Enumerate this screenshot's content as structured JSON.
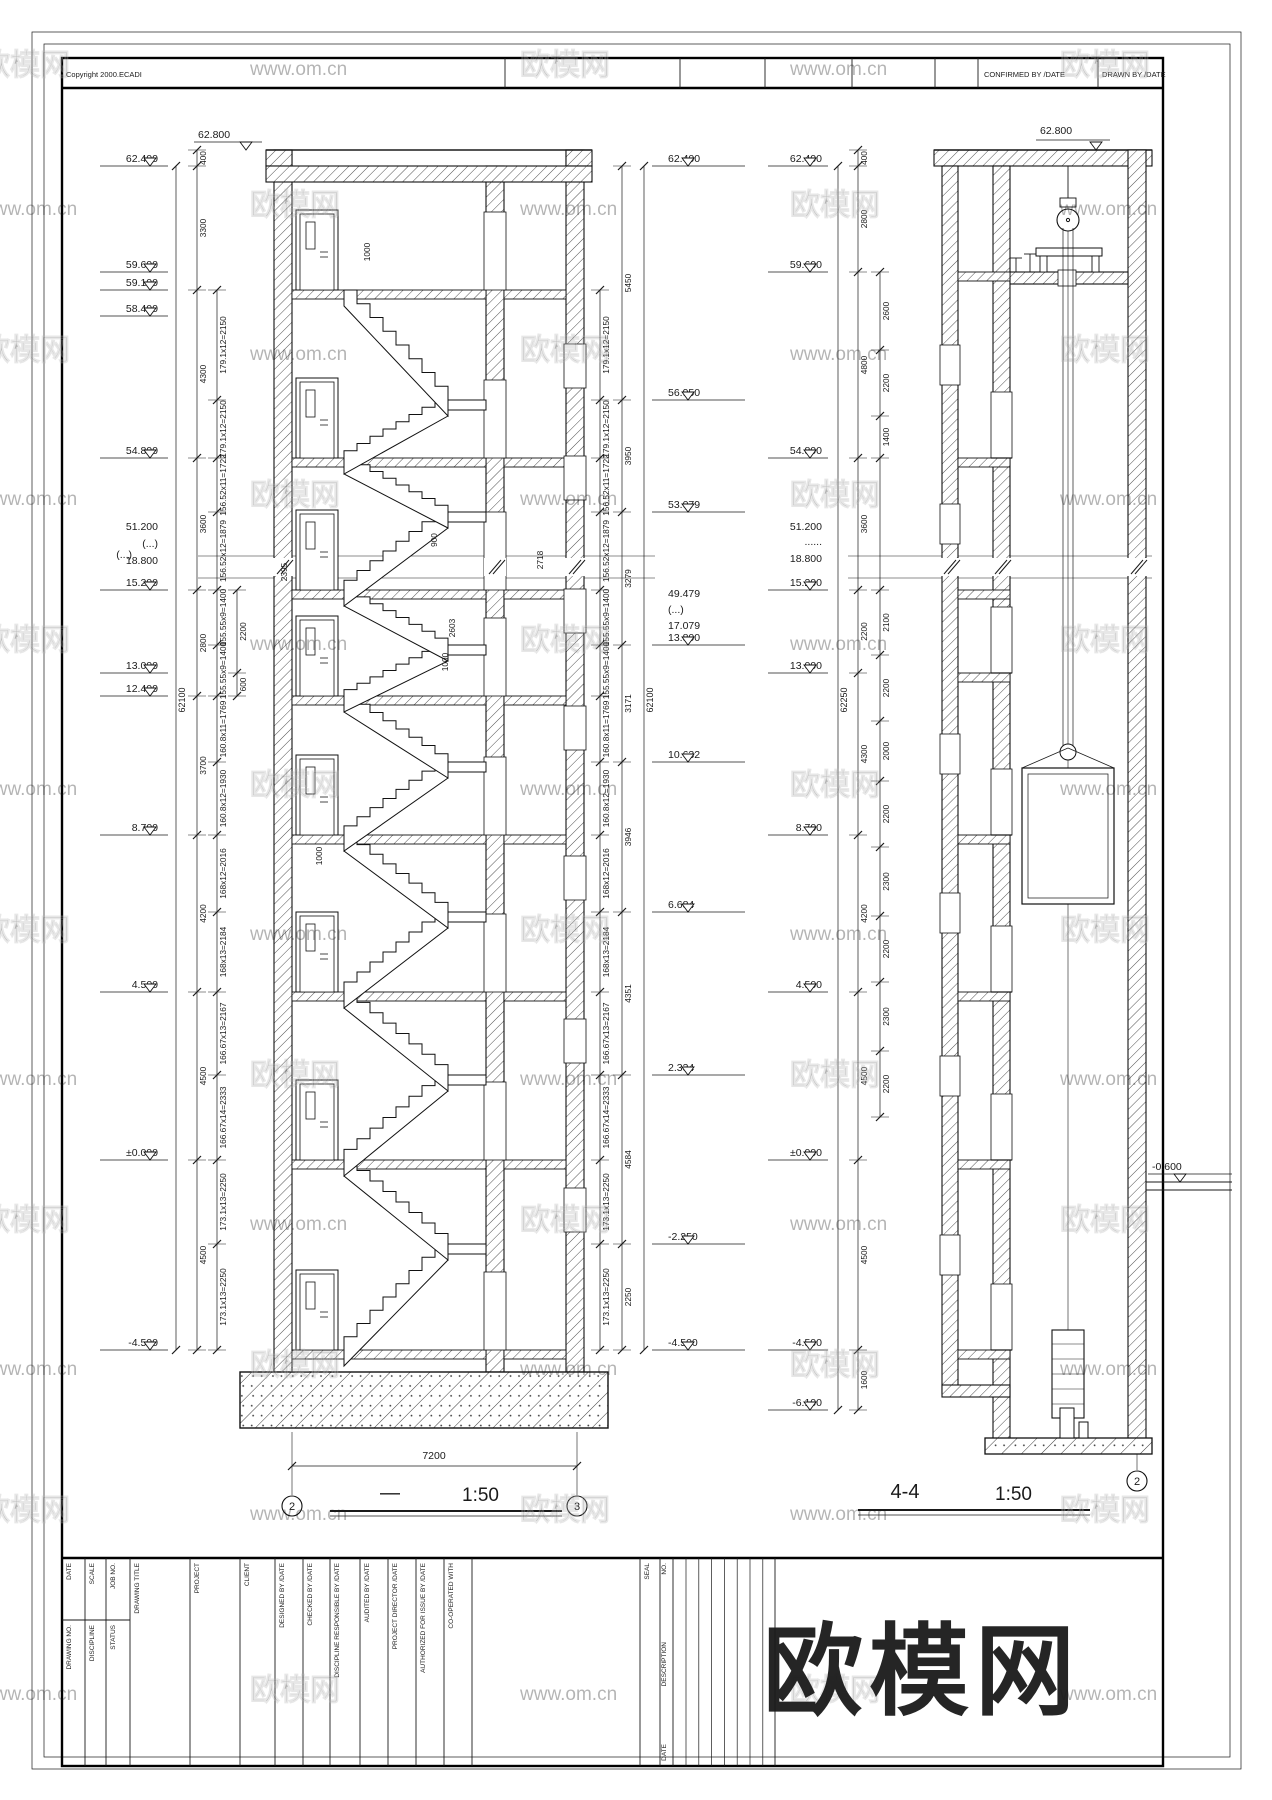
{
  "header": {
    "copyright": "Copyright  2000.ECADI",
    "confirmed": "CONFIRMED BY /DATE",
    "drawn": "DRAWN BY /DATE"
  },
  "watermark": {
    "brand": "欧模网",
    "site": "www.om.cn"
  },
  "stair_section": {
    "title": "—",
    "scale": "1:50",
    "grid_bubbles": [
      "2",
      "3"
    ],
    "width_dim": "7200",
    "overall_dim": "62100",
    "roof_elev": "62.800",
    "break_note": "(...)",
    "elevations_left": [
      {
        "v": "62.400",
        "y": 166
      },
      {
        "v": "59.600",
        "y": 272
      },
      {
        "v": "59.100",
        "y": 290
      },
      {
        "v": "58.400",
        "y": 316
      },
      {
        "v": "54.800",
        "y": 458
      },
      {
        "v": "51.200",
        "y": 534,
        "nf": 1
      },
      {
        "v": "(...)",
        "y": 551,
        "nf": 1
      },
      {
        "v": "18.800",
        "y": 568,
        "nf": 1
      },
      {
        "v": "15.200",
        "y": 590
      },
      {
        "v": "13.000",
        "y": 673
      },
      {
        "v": "12.400",
        "y": 696
      },
      {
        "v": "8.700",
        "y": 835
      },
      {
        "v": "4.500",
        "y": 992
      },
      {
        "v": "±0.000",
        "y": 1160
      },
      {
        "v": "-4.500",
        "y": 1350
      }
    ],
    "elevations_right": [
      {
        "v": "62.400",
        "y": 166
      },
      {
        "v": "56.950",
        "y": 400
      },
      {
        "v": "53.079",
        "y": 512
      },
      {
        "v": "49.479",
        "y": 601,
        "nf": 1
      },
      {
        "v": "(...)",
        "y": 617,
        "nf": 1
      },
      {
        "v": "17.079",
        "y": 633,
        "nf": 1
      },
      {
        "v": "13.800",
        "y": 645
      },
      {
        "v": "10.632",
        "y": 762
      },
      {
        "v": "6.684",
        "y": 912
      },
      {
        "v": "2.334",
        "y": 1075
      },
      {
        "v": "-2.250",
        "y": 1244
      },
      {
        "v": "-4.500",
        "y": 1350
      }
    ],
    "floor_chain": [
      {
        "a": 150,
        "b": 166,
        "v": "400"
      },
      {
        "a": 166,
        "b": 290,
        "v": "3300"
      },
      {
        "a": 290,
        "b": 458,
        "v": "4300"
      },
      {
        "a": 458,
        "b": 590,
        "v": "3600"
      },
      {
        "a": 590,
        "b": 696,
        "v": "2800"
      },
      {
        "a": 696,
        "b": 835,
        "v": "3700"
      },
      {
        "a": 835,
        "b": 992,
        "v": "4200"
      },
      {
        "a": 992,
        "b": 1160,
        "v": "4500"
      },
      {
        "a": 1160,
        "b": 1350,
        "v": "4500"
      }
    ],
    "flight_chain": [
      {
        "a": 290,
        "b": 400,
        "v": "179.1x12=2150"
      },
      {
        "a": 400,
        "b": 458,
        "v": "179.1x12=2150"
      },
      {
        "a": 458,
        "b": 512,
        "v": "156.52x11=1722"
      },
      {
        "a": 512,
        "b": 590,
        "v": "156.52x12=1879"
      },
      {
        "a": 590,
        "b": 645,
        "v": "155.55x9=1400"
      },
      {
        "a": 645,
        "b": 696,
        "v": "155.55x9=1400"
      },
      {
        "a": 696,
        "b": 762,
        "v": "160.8x11=1769"
      },
      {
        "a": 762,
        "b": 835,
        "v": "160.8x12=1930"
      },
      {
        "a": 835,
        "b": 912,
        "v": "168x12=2016"
      },
      {
        "a": 912,
        "b": 992,
        "v": "168x13=2184"
      },
      {
        "a": 992,
        "b": 1075,
        "v": "166.67x13=2167"
      },
      {
        "a": 1075,
        "b": 1160,
        "v": "166.67x14=2333"
      },
      {
        "a": 1160,
        "b": 1244,
        "v": "173.1x13=2250"
      },
      {
        "a": 1244,
        "b": 1350,
        "v": "173.1x13=2250"
      }
    ],
    "mini_chain": [
      {
        "a": 590,
        "b": 673,
        "v": "2200"
      },
      {
        "a": 673,
        "b": 696,
        "v": "600"
      }
    ],
    "right_chain": [
      {
        "a": 166,
        "b": 400,
        "v": "5450"
      },
      {
        "a": 400,
        "b": 512,
        "v": "3950"
      },
      {
        "a": 512,
        "b": 645,
        "v": "3279"
      },
      {
        "a": 645,
        "b": 762,
        "v": "3171"
      },
      {
        "a": 762,
        "b": 912,
        "v": "3946"
      },
      {
        "a": 912,
        "b": 1075,
        "v": "4351"
      },
      {
        "a": 1075,
        "b": 1244,
        "v": "4584"
      },
      {
        "a": 1244,
        "b": 1350,
        "v": "2250"
      }
    ],
    "inner_dims": [
      {
        "v": "1000",
        "x": 370,
        "y": 252
      },
      {
        "v": "900",
        "x": 437,
        "y": 540
      },
      {
        "v": "2718",
        "x": 543,
        "y": 560
      },
      {
        "v": "2395",
        "x": 287,
        "y": 572
      },
      {
        "v": "2603",
        "x": 455,
        "y": 628
      },
      {
        "v": "1000",
        "x": 448,
        "y": 662
      },
      {
        "v": "1000",
        "x": 322,
        "y": 856
      }
    ]
  },
  "shaft_section": {
    "title": "4-4",
    "scale": "1:50",
    "grid_bubble": "2",
    "overall_dim": "62250",
    "roof_elev": "62.800",
    "grade_elev": "-0.600",
    "elevations": [
      {
        "v": "62.400",
        "y": 166
      },
      {
        "v": "59.600",
        "y": 272
      },
      {
        "v": "54.800",
        "y": 458
      },
      {
        "v": "51.200",
        "y": 534,
        "nf": 1
      },
      {
        "v": "......",
        "y": 549,
        "nf": 1
      },
      {
        "v": "18.800",
        "y": 566,
        "nf": 1
      },
      {
        "v": "15.200",
        "y": 590
      },
      {
        "v": "13.000",
        "y": 673
      },
      {
        "v": "8.700",
        "y": 835
      },
      {
        "v": "4.500",
        "y": 992
      },
      {
        "v": "±0.000",
        "y": 1160
      },
      {
        "v": "-4.500",
        "y": 1350
      },
      {
        "v": "-6.100",
        "y": 1410
      }
    ],
    "floor_chain": [
      {
        "a": 150,
        "b": 166,
        "v": "400"
      },
      {
        "a": 166,
        "b": 272,
        "v": "2800"
      },
      {
        "a": 272,
        "b": 458,
        "v": "4800"
      },
      {
        "a": 458,
        "b": 590,
        "v": "3600"
      },
      {
        "a": 590,
        "b": 673,
        "v": "2200"
      },
      {
        "a": 673,
        "b": 835,
        "v": "4300"
      },
      {
        "a": 835,
        "b": 992,
        "v": "4200"
      },
      {
        "a": 992,
        "b": 1160,
        "v": "4500"
      },
      {
        "a": 1160,
        "b": 1350,
        "v": "4500"
      },
      {
        "a": 1350,
        "b": 1410,
        "v": "1600"
      }
    ],
    "opening_chain": [
      {
        "a": 272,
        "b": 350,
        "v": "2600"
      },
      {
        "a": 350,
        "b": 416,
        "v": "2200"
      },
      {
        "a": 416,
        "b": 458,
        "v": "1400"
      },
      {
        "a": 590,
        "b": 655,
        "v": "2100"
      },
      {
        "a": 655,
        "b": 721,
        "v": "2200"
      },
      {
        "a": 721,
        "b": 781,
        "v": "2000"
      },
      {
        "a": 781,
        "b": 847,
        "v": "2200"
      },
      {
        "a": 847,
        "b": 916,
        "v": "2300"
      },
      {
        "a": 916,
        "b": 982,
        "v": "2200"
      },
      {
        "a": 982,
        "b": 1051,
        "v": "2300"
      },
      {
        "a": 1051,
        "b": 1117,
        "v": "2200"
      }
    ]
  },
  "title_block": {
    "small_cells_top": [
      "DATE",
      "SCALE",
      "JOB NO."
    ],
    "small_cells_bottom": [
      "DRAWING NO.",
      "DISCIPLINE",
      "STATUS"
    ],
    "columns": [
      "DRAWING TITLE",
      "PROJECT",
      "CLIENT",
      "DESIGNED BY /DATE",
      "CHECKED BY /DATE",
      "DISCIPLINE RESPONSIBLE BY /DATE",
      "AUDITED BY /DATE",
      "PROJECT DIRECTOR /DATE",
      "AUTHORIZED FOR ISSUE BY /DATE",
      "CO-OPERATED WITH"
    ],
    "seal": "SEAL",
    "revision": [
      "NO.",
      "DESCRIPTION",
      "DATE"
    ]
  }
}
